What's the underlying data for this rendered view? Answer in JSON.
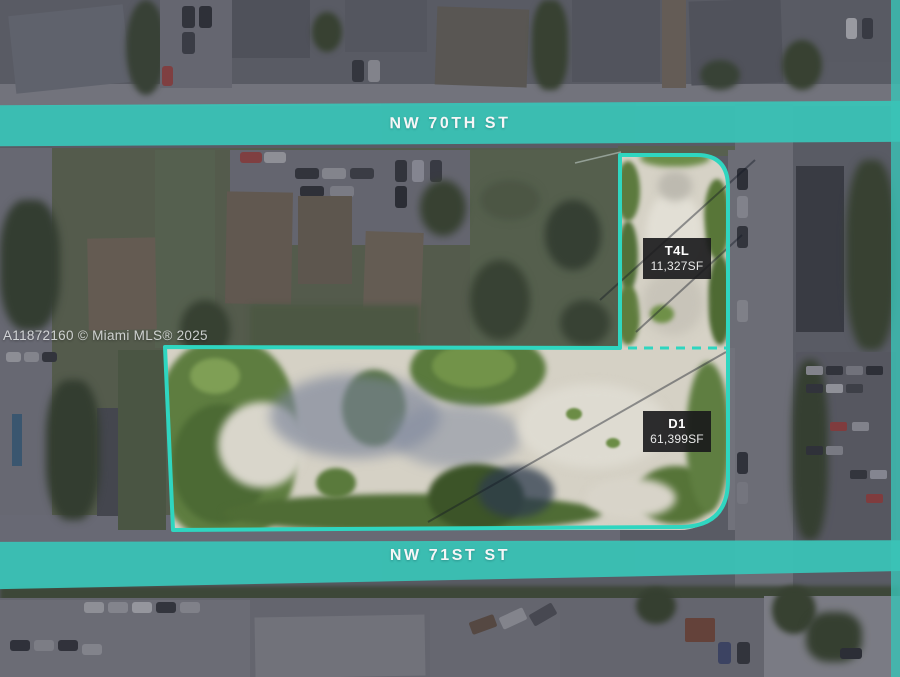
{
  "watermark": "A11872160 © Miami MLS® 2025",
  "streets": {
    "top": "NW 70TH ST",
    "bottom": "NW 71ST ST"
  },
  "parcels": [
    {
      "id": "T4L",
      "area": "11,327SF"
    },
    {
      "id": "D1",
      "area": "61,399SF"
    }
  ],
  "colors": {
    "highlight_teal": "#3ac3b6",
    "parcel_outline": "#2fd6c0",
    "label_background": "#1a1a1b",
    "label_text": "#ffffff",
    "parcel_sand": "#d5d1c5",
    "parcel_vegetation": "#5e7d40"
  }
}
